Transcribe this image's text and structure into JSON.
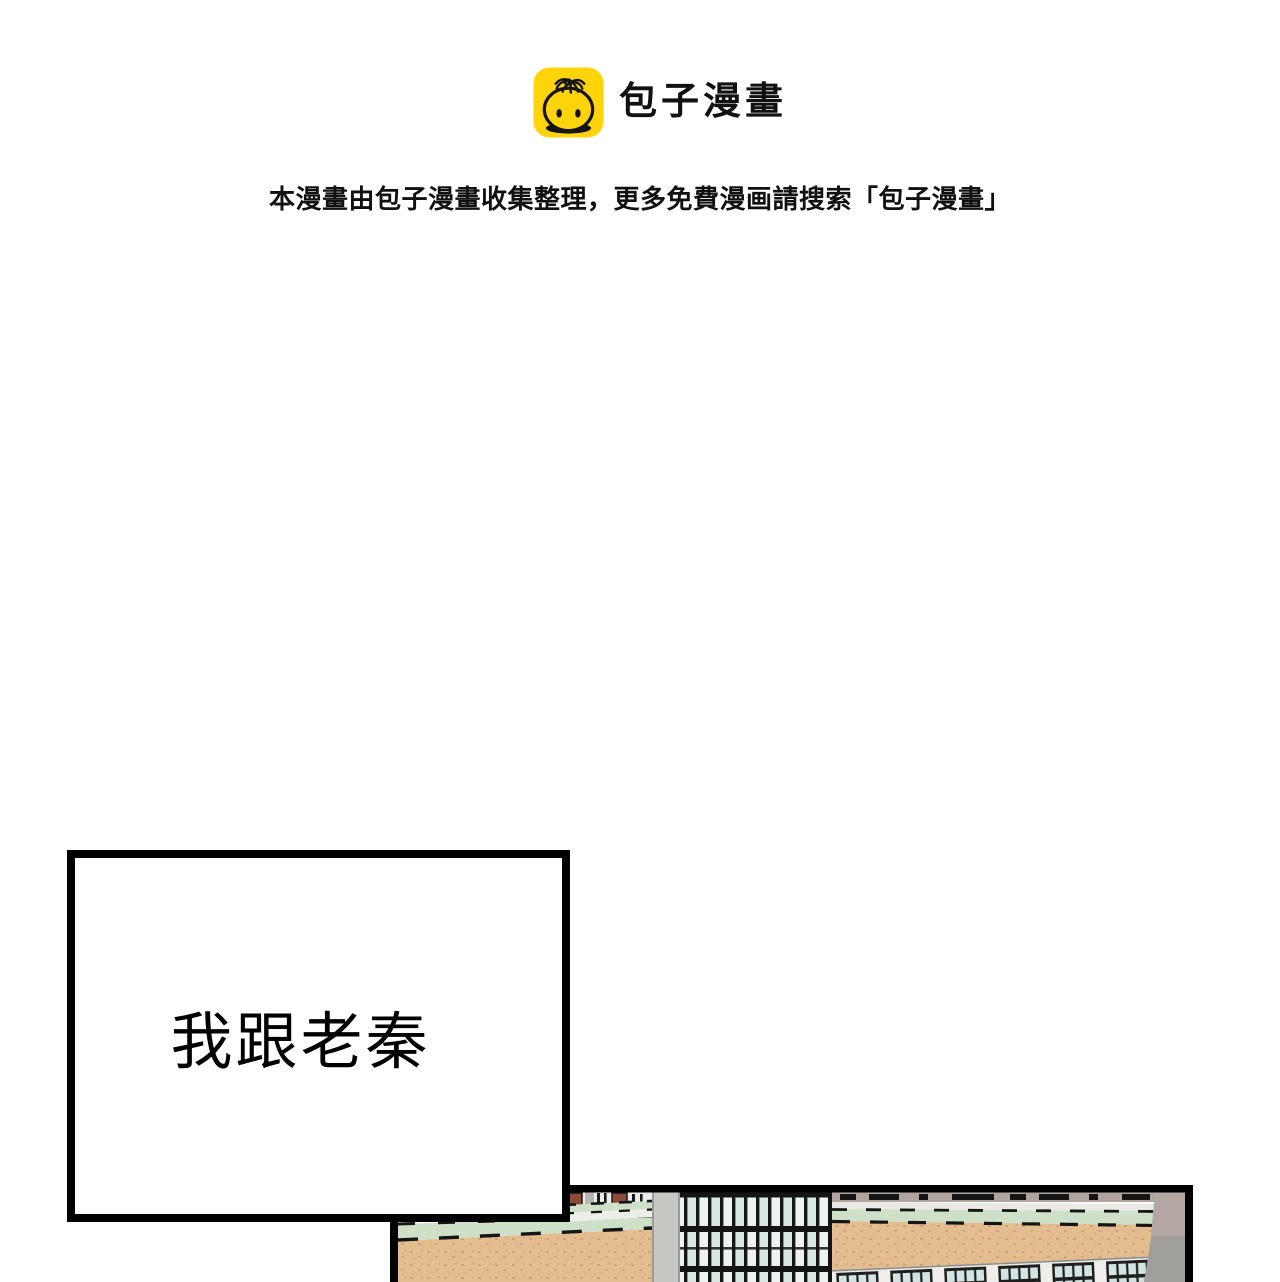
{
  "page": {
    "width": 1280,
    "height": 1282,
    "background": "#ffffff"
  },
  "header": {
    "logo": {
      "title": "包子漫畫",
      "icon": "baozi-bun-icon",
      "icon_bg": "#ffd40a",
      "icon_line": "#141414"
    },
    "notice": "本漫畫由包子漫畫收集整理，更多免費漫画請搜索「包子漫畫」"
  },
  "panel": {
    "speech_bubble": {
      "text": "我跟老秦",
      "fill": "#ffffff",
      "border": "#000000"
    },
    "illustration": {
      "name": "school-building-bottom-crop",
      "colors": {
        "outline": "#000000",
        "brick": "#e3bd90",
        "brick_speckle": "#c49a6c",
        "band_green": "#cfe0c8",
        "band_white": "#ededea",
        "glass_light": "#eef4f2",
        "glass_shade": "#d9e7e4",
        "mullion": "#161616",
        "wall_gray": "#c7c7c4",
        "side_gray": "#a19f9b",
        "roof_mauve": "#b0a49f",
        "roof_maroon": "#8c4a38",
        "window_pane": "#d3e5e3",
        "window_frame": "#1f1f1f"
      }
    }
  }
}
